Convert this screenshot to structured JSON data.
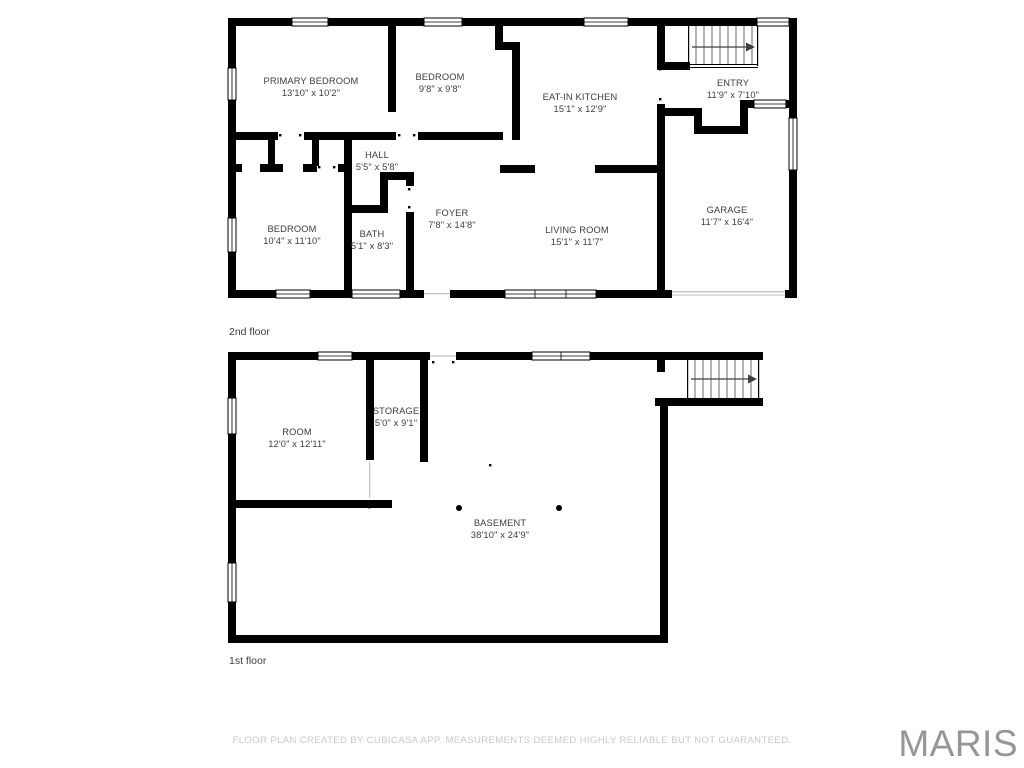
{
  "floors": [
    {
      "label": "2nd floor",
      "rooms": [
        {
          "name": "PRIMARY BEDROOM",
          "dims": "13'10\" x 10'2\""
        },
        {
          "name": "BEDROOM",
          "dims": "9'8\" x 9'8\""
        },
        {
          "name": "EAT-IN KITCHEN",
          "dims": "15'1\" x 12'9\""
        },
        {
          "name": "ENTRY",
          "dims": "11'9\" x 7'10\""
        },
        {
          "name": "HALL",
          "dims": "5'5\" x 5'8\""
        },
        {
          "name": "BEDROOM",
          "dims": "10'4\" x 11'10\""
        },
        {
          "name": "BATH",
          "dims": "5'1\" x 8'3\""
        },
        {
          "name": "FOYER",
          "dims": "7'8\" x 14'8\""
        },
        {
          "name": "LIVING ROOM",
          "dims": "15'1\" x 11'7\""
        },
        {
          "name": "GARAGE",
          "dims": "11'7\" x 16'4\""
        }
      ]
    },
    {
      "label": "1st floor",
      "rooms": [
        {
          "name": "ROOM",
          "dims": "12'0\" x 12'11\""
        },
        {
          "name": "STORAGE",
          "dims": "5'0\" x 9'1\""
        },
        {
          "name": "BASEMENT",
          "dims": "38'10\" x 24'9\""
        }
      ]
    }
  ],
  "footer": {
    "disclaimer": "FLOOR PLAN CREATED BY CUBICASA APP. MEASUREMENTS DEEMED HIGHLY RELIABLE BUT NOT GUARANTEED."
  },
  "watermark": "MARIS",
  "colors": {
    "wall": "#000000",
    "label": "#3d3d3d",
    "disclaimer": "#c9c9c9",
    "watermark": "#969696",
    "faint": "#c4c4c4"
  }
}
